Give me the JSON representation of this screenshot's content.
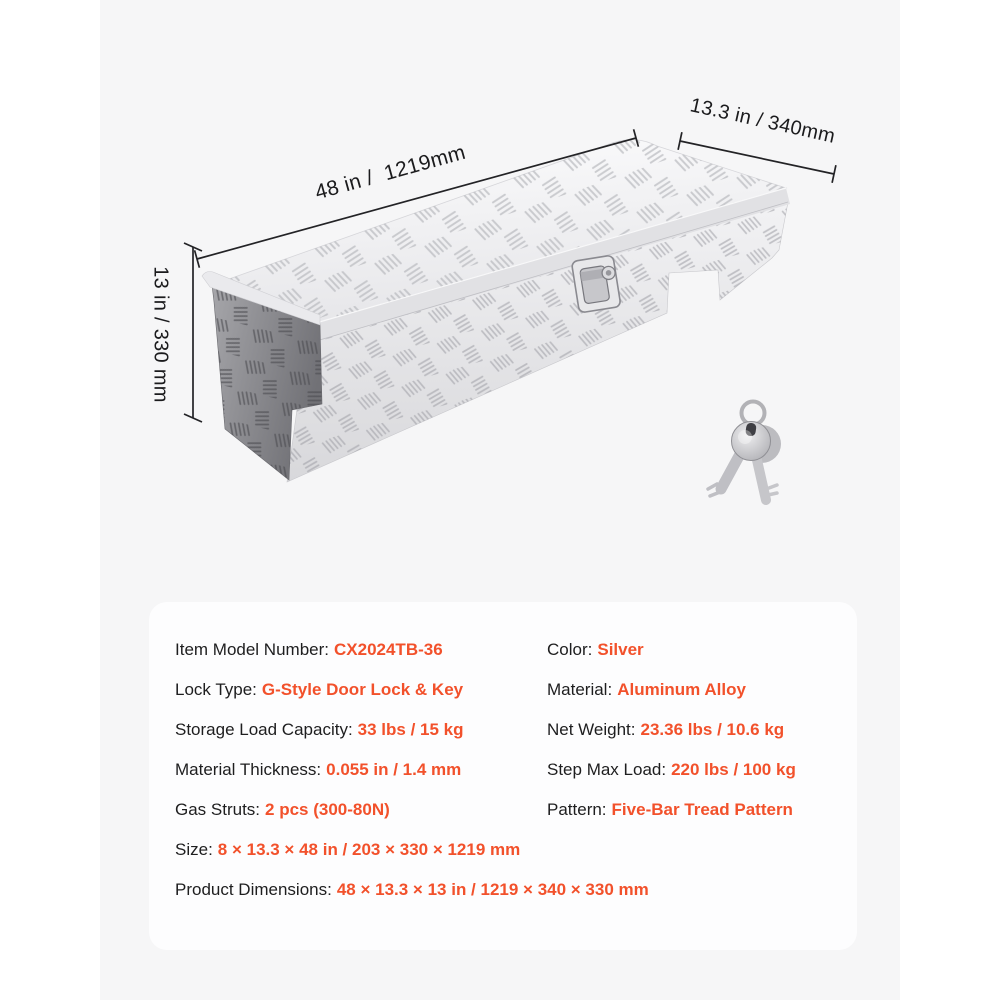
{
  "page": {
    "background": "#ffffff",
    "stage_background": "#f6f6f7",
    "panel_background": "#fdfdfe",
    "accent_color": "#f2512b",
    "text_color": "#1e1e1f"
  },
  "figure": {
    "product": "aluminum tread-plate side-mount tool box",
    "icons": [
      "tool-box-illustration",
      "latch-icon",
      "keys-icon"
    ]
  },
  "dimension_labels": {
    "length": "48 in /  1219mm",
    "depth": "13.3 in / 340mm",
    "height": "13 in / 330 mm"
  },
  "specs": {
    "left": [
      {
        "label": "Item Model Number:",
        "value": "CX2024TB-36"
      },
      {
        "label": "Lock Type:",
        "value": "G-Style Door Lock & Key"
      },
      {
        "label": "Storage Load Capacity:",
        "value": "33 lbs / 15 kg"
      },
      {
        "label": "Material Thickness:",
        "value": "0.055 in / 1.4 mm"
      },
      {
        "label": "Gas Struts:",
        "value": "2 pcs (300-80N)"
      }
    ],
    "right": [
      {
        "label": "Color:",
        "value": "Silver"
      },
      {
        "label": "Material:",
        "value": "Aluminum Alloy"
      },
      {
        "label": "Net Weight:",
        "value": "23.36 lbs / 10.6 kg"
      },
      {
        "label": "Step Max Load:",
        "value": "220 lbs / 100 kg"
      },
      {
        "label": "Pattern:",
        "value": "Five-Bar Tread Pattern"
      }
    ],
    "wide": [
      {
        "label": "Size:",
        "value": "8 × 13.3 × 48 in / 203 × 330 × 1219 mm"
      },
      {
        "label": "Product Dimensions:",
        "value": "48 × 13.3 × 13 in / 1219 × 340 × 330 mm"
      }
    ]
  }
}
